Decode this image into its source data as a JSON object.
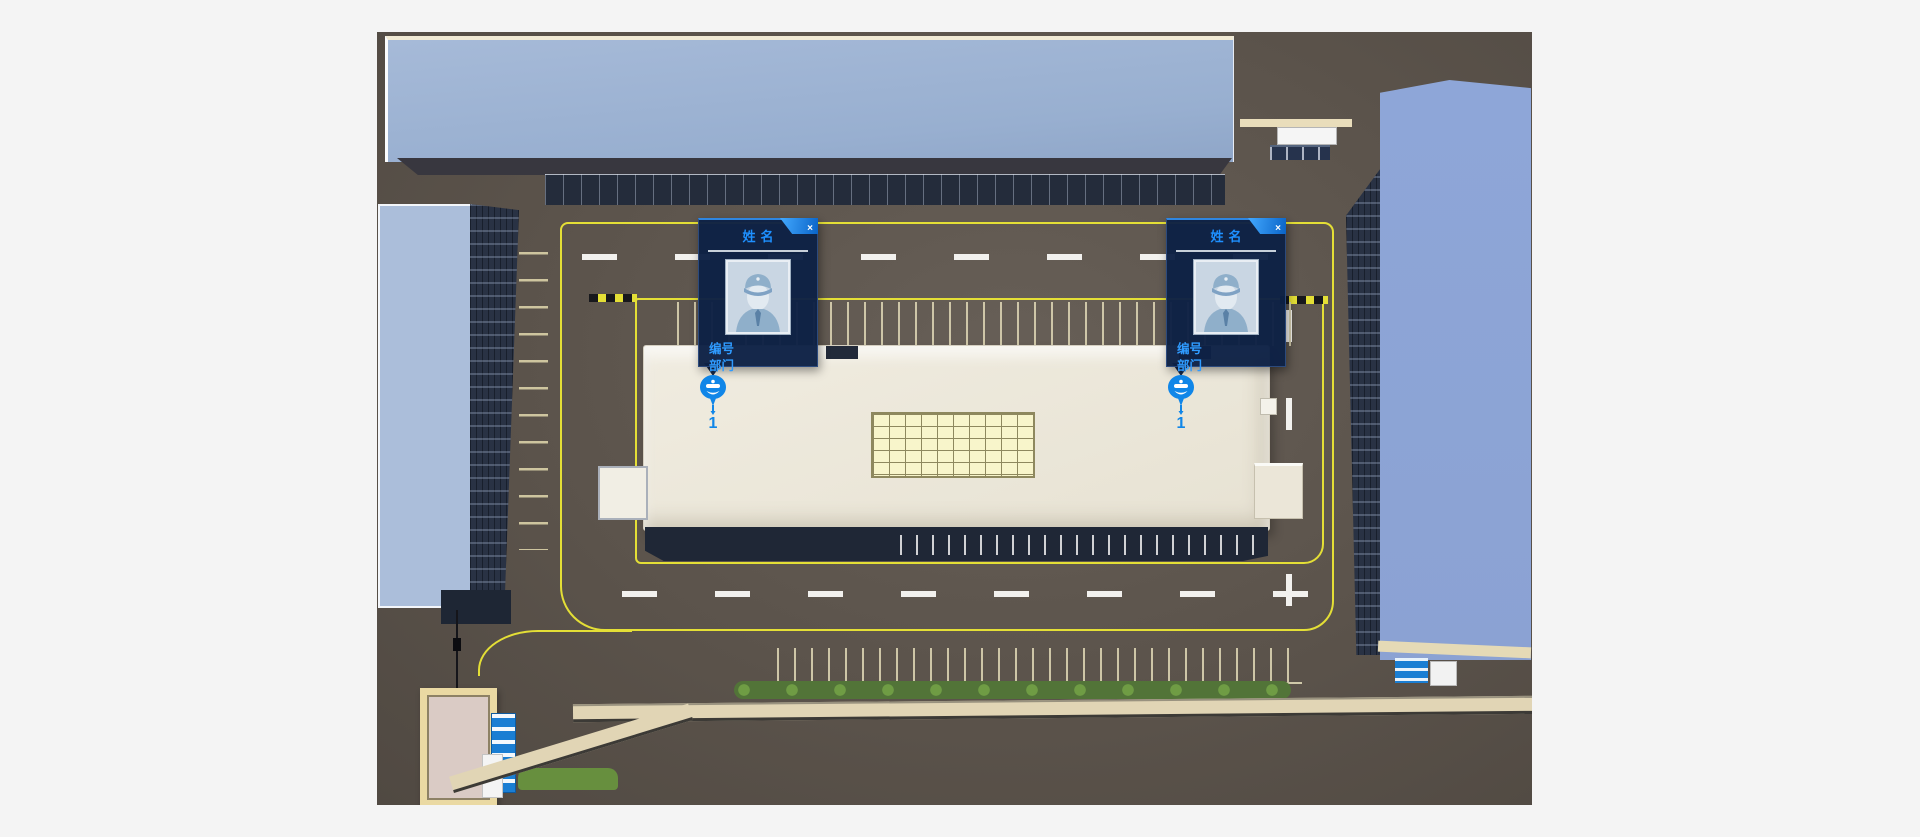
{
  "palette": {
    "canvas_bg": "#f4f4f4",
    "ground": "#5b534b",
    "roof_blue_top": "#9cb2d2",
    "roof_blue_right": "#8ca4d6",
    "facade_dark": "#293244",
    "road_yellow": "#e4df36",
    "road_white": "#f2f1ee",
    "central_building_cream": "#ece7da",
    "skylight_yellow": "#f8f5cb",
    "hedge_green": "#527438",
    "card_bg": "#0d2145",
    "accent_blue": "#1e8fff",
    "pin_blue": "#1086e8"
  },
  "cards": [
    {
      "title": "姓名",
      "close": "×",
      "fields": [
        {
          "label": "编号"
        },
        {
          "label": "部门"
        }
      ],
      "pin": {
        "count": "1"
      }
    },
    {
      "title": "姓名",
      "close": "×",
      "fields": [
        {
          "label": "编号"
        },
        {
          "label": "部门"
        }
      ],
      "pin": {
        "count": "1"
      }
    }
  ]
}
